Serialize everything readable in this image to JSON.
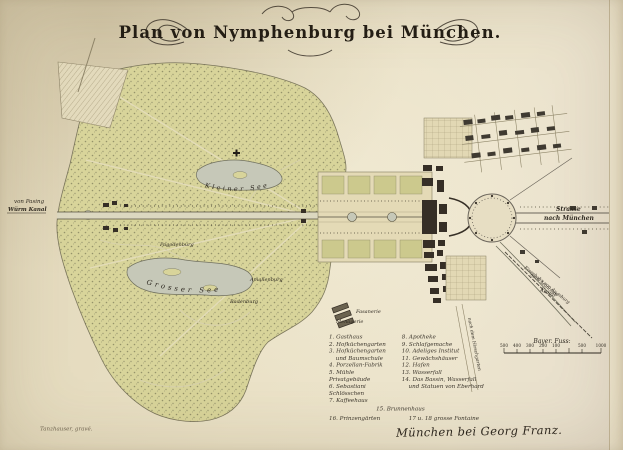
{
  "title": {
    "text": "Plan von Nymphenburg bei München."
  },
  "labels": {
    "kleiner_see": "Kleiner See",
    "grosser_see": "Grosser See",
    "badenburg": "Badenburg",
    "pagodenburg": "Pagodenburg",
    "amalienburg": "Amalienburg",
    "fasanerie": "Fasanerie",
    "menagerie": "Menagerie",
    "von_pasing": "von Pasing",
    "wuerm_kanal": "Würm Kanal",
    "strasse": "Strasse",
    "nach_muenchen": "nach München",
    "kanal": "Kanal",
    "nach_hirschgarten": "nach dem Hirschgarten",
    "eisenbahn_1": "Eisenbahn von Augsburg",
    "eisenbahn_2": "nach München"
  },
  "legend": {
    "col1": [
      "1. Gasthaus",
      "2. Hofküchengarten",
      "3. Hofküchengarten",
      "und Baumschule",
      "4. Porzellan-Fabrik",
      "5. Mühle Privatgebäude",
      "6. Sebastiani Schlösschen",
      "7. Kaffeehaus"
    ],
    "col2": [
      "8. Apotheke",
      "9. Schlafgemache",
      "10. Adeliges Institut",
      "11. Gewächshäuser",
      "12. Hafen",
      "13. Wasserfall",
      "14. Das Bassin, Wasserfall",
      "und Statuen von Eberhard"
    ],
    "row15": "15. Brunnenhaus",
    "row16": "16. Prinzengärten",
    "row17": "17 u. 18 grosse Fontaine"
  },
  "scale": {
    "label": "Bayer. Fuss:",
    "ticks": [
      "500",
      "400",
      "300",
      "200",
      "100",
      "500",
      "1000"
    ]
  },
  "imprint": {
    "publisher": "München bei Georg Franz.",
    "engraver": "Tanzhauser, gravé."
  },
  "colors": {
    "paper": "#eae1c6",
    "park_green": "#d8d49a",
    "water": "#c6c8b8",
    "building_ink": "#362f26",
    "map_ink": "#2e2921"
  }
}
